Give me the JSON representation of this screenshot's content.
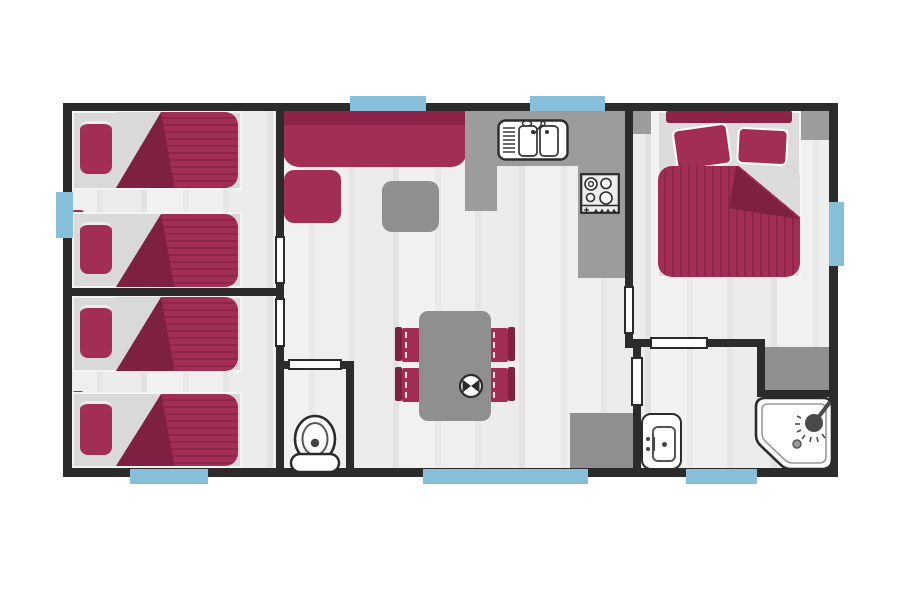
{
  "title": "mobile-home floor plan",
  "colors": {
    "wall": "#2b2b2b",
    "floor": "#ebebeb",
    "maroon": "#a22e56",
    "maroon-mid": "#8d2349",
    "maroon-dark": "#7e2042",
    "stripe": "#8c264c",
    "gray": "#8f8f8f",
    "counter": "#9c9c9c",
    "frame": "#d9d9d9",
    "window": "#87bed9",
    "fixture": "#ffffff",
    "outline": "#2f2f2f"
  },
  "plan": {
    "rooms": [
      {
        "name": "twin-bedroom-front",
        "furniture": [
          "single-bed",
          "single-bed",
          "headboard-shelf",
          "headboard-shelf"
        ]
      },
      {
        "name": "twin-bedroom-rear",
        "furniture": [
          "single-bed",
          "single-bed",
          "headboard-shelf",
          "headboard-shelf"
        ]
      },
      {
        "name": "living-area",
        "furniture": [
          "bench-sofa",
          "armchair",
          "coffee-table"
        ]
      },
      {
        "name": "kitchen",
        "furniture": [
          "counter",
          "double-sink",
          "four-burner-hob"
        ]
      },
      {
        "name": "dining-area",
        "furniture": [
          "dining-table",
          "chair",
          "chair",
          "chair",
          "chair",
          "plate-with-cutlery",
          "tech-cabinet"
        ]
      },
      {
        "name": "wc",
        "furniture": [
          "toilet"
        ]
      },
      {
        "name": "master-bedroom",
        "furniture": [
          "double-bed",
          "nightstand",
          "nightstand",
          "wardrobe"
        ]
      },
      {
        "name": "bathroom",
        "furniture": [
          "washbasin",
          "corner-shower"
        ]
      }
    ],
    "window_count": 7,
    "door_count": 6
  }
}
